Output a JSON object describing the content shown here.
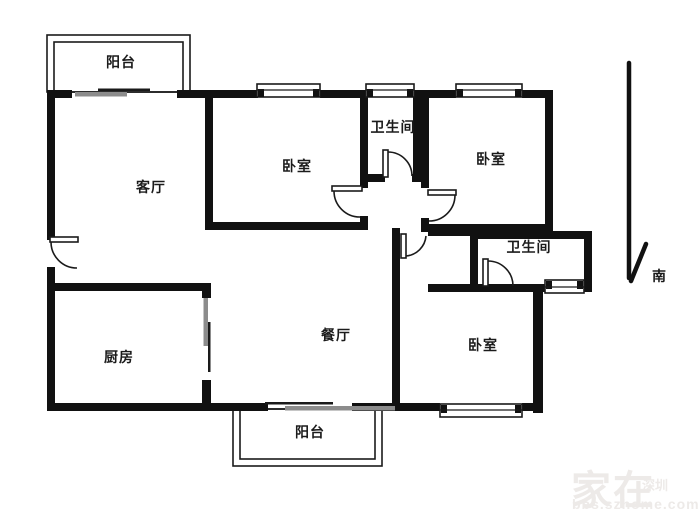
{
  "rooms": {
    "balcony_top": {
      "label": "阳台"
    },
    "living": {
      "label": "客厅"
    },
    "bedroom1": {
      "label": "卧室"
    },
    "bathroom1": {
      "label": "卫生间"
    },
    "bedroom2": {
      "label": "卧室"
    },
    "bathroom2": {
      "label": "卫生间"
    },
    "dining": {
      "label": "餐厅"
    },
    "kitchen": {
      "label": "厨房"
    },
    "bedroom3": {
      "label": "卧室"
    },
    "balcony_bottom": {
      "label": "阳台"
    }
  },
  "compass": {
    "south_label": "南"
  },
  "watermark": {
    "brand": "家在",
    "city": "深圳",
    "site": "bbs.szhome.com"
  },
  "colors": {
    "wall": "#111111",
    "line": "#1a1a1a",
    "slider_gray": "#8c8c8c",
    "watermark": "#edeae8"
  }
}
